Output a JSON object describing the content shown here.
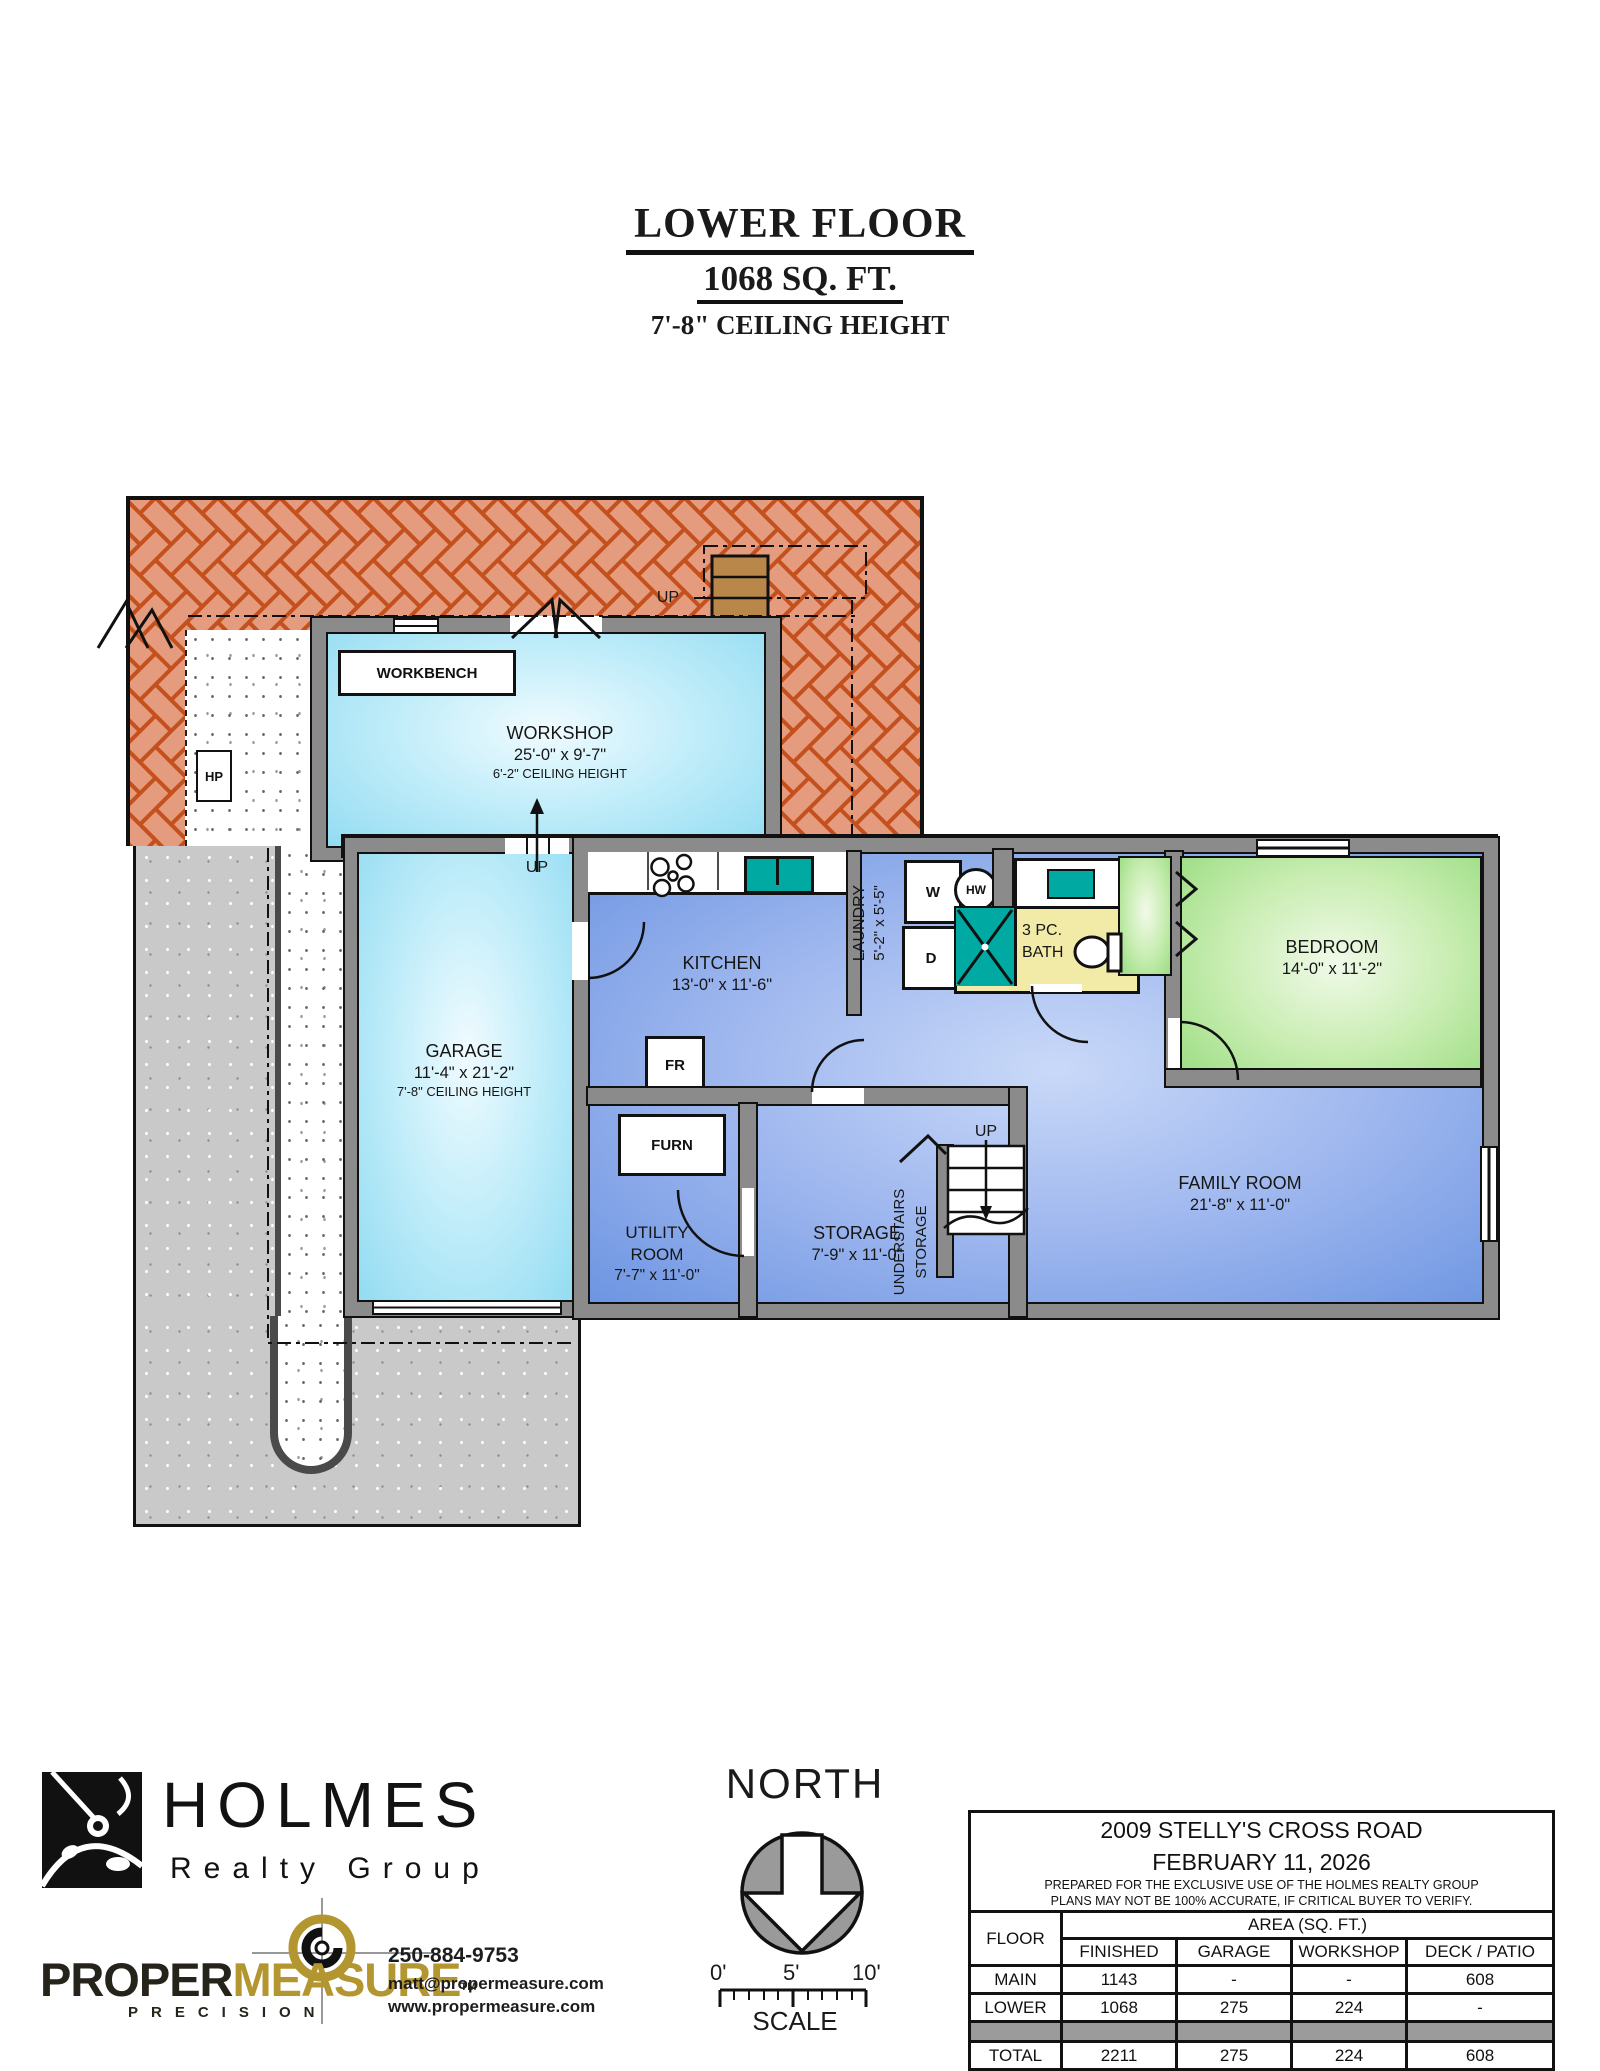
{
  "title": {
    "line1": "LOWER FLOOR",
    "line2": "1068 SQ. FT.",
    "line3": "7'-8\" CEILING HEIGHT"
  },
  "plan": {
    "rooms": {
      "workshop": {
        "name": "WORKSHOP",
        "dims": "25'-0\" x 9'-7\"",
        "ceiling": "6'-2\" CEILING HEIGHT"
      },
      "garage": {
        "name": "GARAGE",
        "dims": "11'-4\" x 21'-2\"",
        "ceiling": "7'-8\" CEILING HEIGHT"
      },
      "kitchen": {
        "name": "KITCHEN",
        "dims": "13'-0\" x 11'-6\""
      },
      "laundry": {
        "name": "LAUNDRY",
        "dims": "5'-2\" x 5'-5\""
      },
      "bath": {
        "name_line1": "3 PC.",
        "name_line2": "BATH"
      },
      "bedroom": {
        "name": "BEDROOM",
        "dims": "14'-0\" x 11'-2\""
      },
      "family_room": {
        "name": "FAMILY ROOM",
        "dims": "21'-8\" x 11'-0\""
      },
      "storage": {
        "name": "STORAGE",
        "dims": "7'-9\" x 11'-0\""
      },
      "utility": {
        "name_line1": "UTILITY",
        "name_line2": "ROOM",
        "dims": "7'-7\" x 11'-0\""
      },
      "understairs": {
        "name_line1": "UNDERSTAIRS",
        "name_line2": "STORAGE"
      }
    },
    "labels": {
      "workbench": "WORKBENCH",
      "up": "UP",
      "hp": "HP",
      "washer": "W",
      "dryer": "D",
      "hot_water": "HW",
      "fridge": "FR",
      "furnace": "FURN"
    },
    "colors": {
      "brick": "#e59b7d",
      "mortar": "#c4501e",
      "wall_gray": "#8b8b8b",
      "room_blue": "#6d95e2",
      "room_cyan": "#93dcf2",
      "room_green": "#98dc80",
      "bath_yellow": "#f2eba8",
      "fixture_teal": "#00a9a2"
    }
  },
  "footer": {
    "holmes": {
      "name": "HOLMES",
      "tagline": "Realty Group"
    },
    "propermeasure": {
      "part1": "PROPER",
      "part2": "MEASURE",
      "tm": "TM",
      "tagline": "PRECISION",
      "phone": "250-884-9753",
      "email": "matt@propermeasure.com",
      "website": "www.propermeasure.com"
    },
    "compass": {
      "label": "NORTH",
      "scale_label": "SCALE",
      "ticks": [
        "0'",
        "5'",
        "10'"
      ]
    }
  },
  "info_table": {
    "address": "2009 STELLY'S CROSS ROAD",
    "date": "FEBRUARY 11, 2026",
    "disclaimer1": "PREPARED FOR THE EXCLUSIVE USE OF THE HOLMES REALTY GROUP",
    "disclaimer2": "PLANS MAY NOT BE 100% ACCURATE, IF CRITICAL BUYER TO VERIFY.",
    "col_floor": "FLOOR",
    "col_area": "AREA (SQ. FT.)",
    "columns": [
      "FINISHED",
      "GARAGE",
      "WORKSHOP",
      "DECK / PATIO"
    ],
    "rows": [
      {
        "floor": "MAIN",
        "finished": "1143",
        "garage": "-",
        "workshop": "-",
        "deck": "608"
      },
      {
        "floor": "LOWER",
        "finished": "1068",
        "garage": "275",
        "workshop": "224",
        "deck": "-"
      },
      {
        "floor": "TOTAL",
        "finished": "2211",
        "garage": "275",
        "workshop": "224",
        "deck": "608"
      }
    ]
  }
}
